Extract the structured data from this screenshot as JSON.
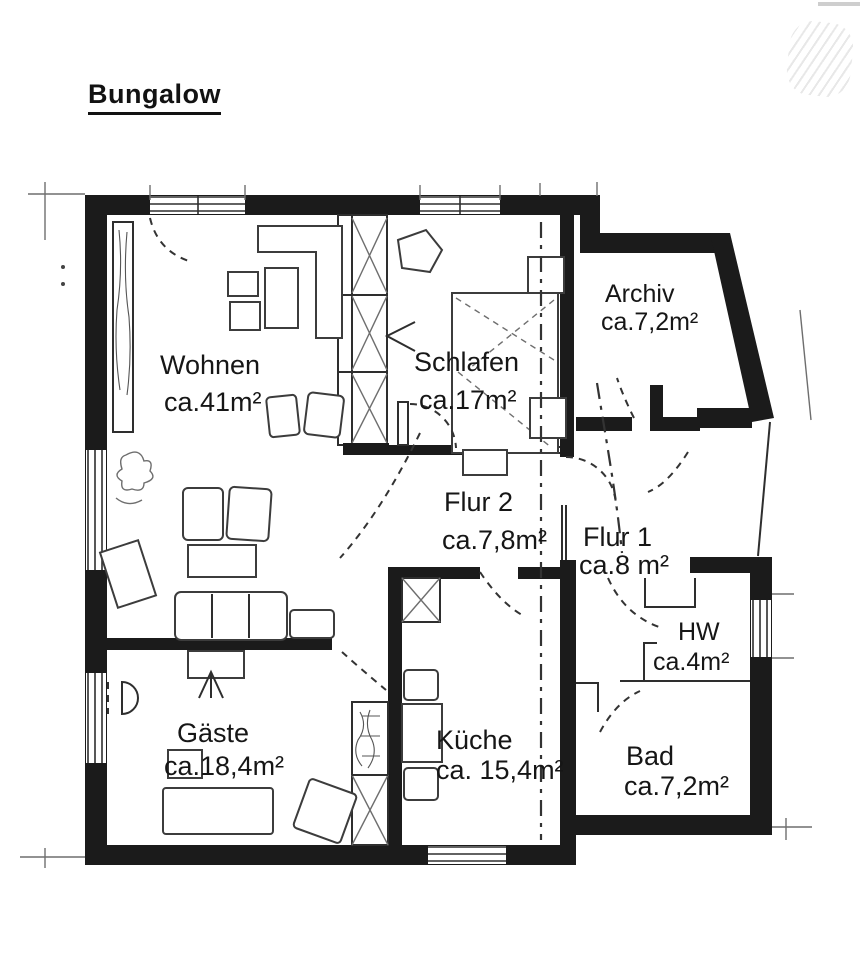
{
  "title": "Bungalow",
  "rooms": [
    {
      "name": "Wohnen",
      "area": "ca.41m²"
    },
    {
      "name": "Schlafen",
      "area": "ca.17m²"
    },
    {
      "name": "Archiv",
      "area": "ca.7,2m²"
    },
    {
      "name": "Flur 2",
      "area": "ca.7,8m²"
    },
    {
      "name": "Flur 1",
      "area": "ca.8 m²"
    },
    {
      "name": "HW",
      "area": "ca.4m²"
    },
    {
      "name": "Bad",
      "area": "ca.7,2m²"
    },
    {
      "name": "Küche",
      "area": "ca. 15,4m²"
    },
    {
      "name": "Gäste",
      "area": "ca.18,4m²"
    }
  ],
  "colors": {
    "ink": "#1b1b1b",
    "paper": "#ffffff"
  }
}
